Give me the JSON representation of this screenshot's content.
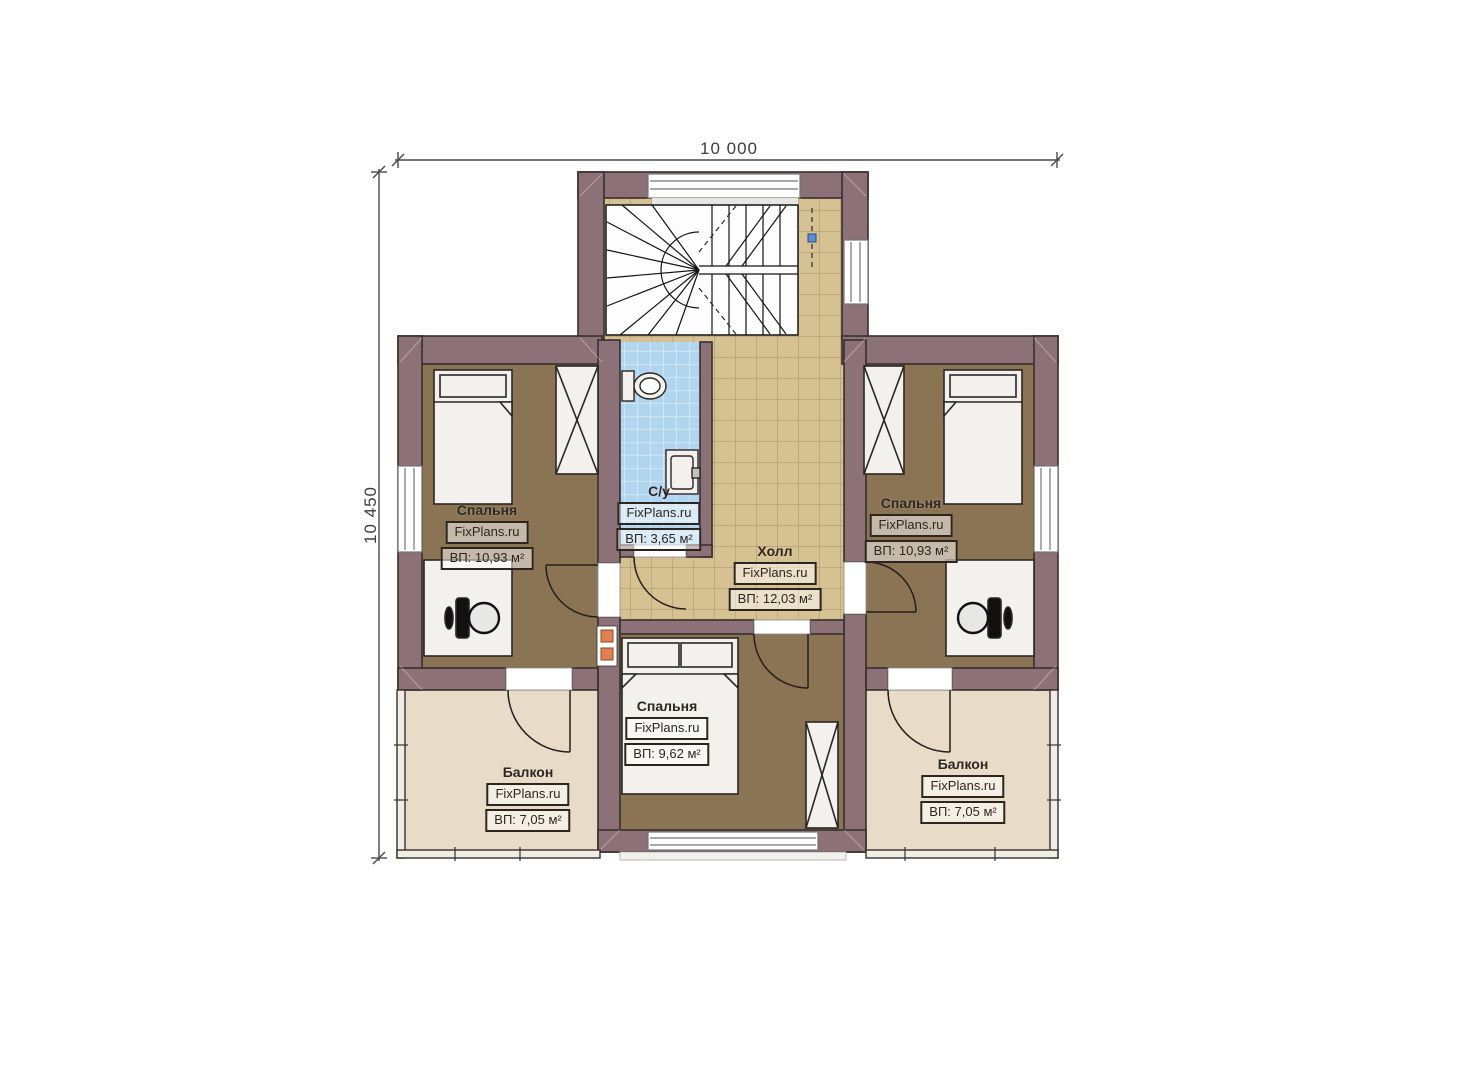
{
  "plan": {
    "dimensions": {
      "width_label": "10 000",
      "height_label": "10 450"
    },
    "rooms": [
      {
        "key": "bedroom-left",
        "name": "Спальня",
        "watermark": "FixPlans.ru",
        "area": "ВП: 10,93 м²"
      },
      {
        "key": "bedroom-right",
        "name": "Спальня",
        "watermark": "FixPlans.ru",
        "area": "ВП: 10,93 м²"
      },
      {
        "key": "bathroom",
        "name": "С/у",
        "watermark": "FixPlans.ru",
        "area": "ВП: 3,65 м²"
      },
      {
        "key": "hall",
        "name": "Холл",
        "watermark": "FixPlans.ru",
        "area": "ВП: 12,03 м²"
      },
      {
        "key": "bedroom-bottom",
        "name": "Спальня",
        "watermark": "FixPlans.ru",
        "area": "ВП: 9,62 м²"
      },
      {
        "key": "balcony-left",
        "name": "Балкон",
        "watermark": "FixPlans.ru",
        "area": "ВП: 7,05 м²"
      },
      {
        "key": "balcony-right",
        "name": "Балкон",
        "watermark": "FixPlans.ru",
        "area": "ВП: 7,05 м²"
      }
    ],
    "colors": {
      "wall": "#8c7178",
      "tile_floor": "#d6c193",
      "bedroom_floor": "#8a7453",
      "balcony_floor": "#e8dcc8",
      "bathroom_floor": "#b1d4ef",
      "background": "#ffffff",
      "vent_marker": "#de8152",
      "stair_marker": "#5b8fd6"
    }
  }
}
